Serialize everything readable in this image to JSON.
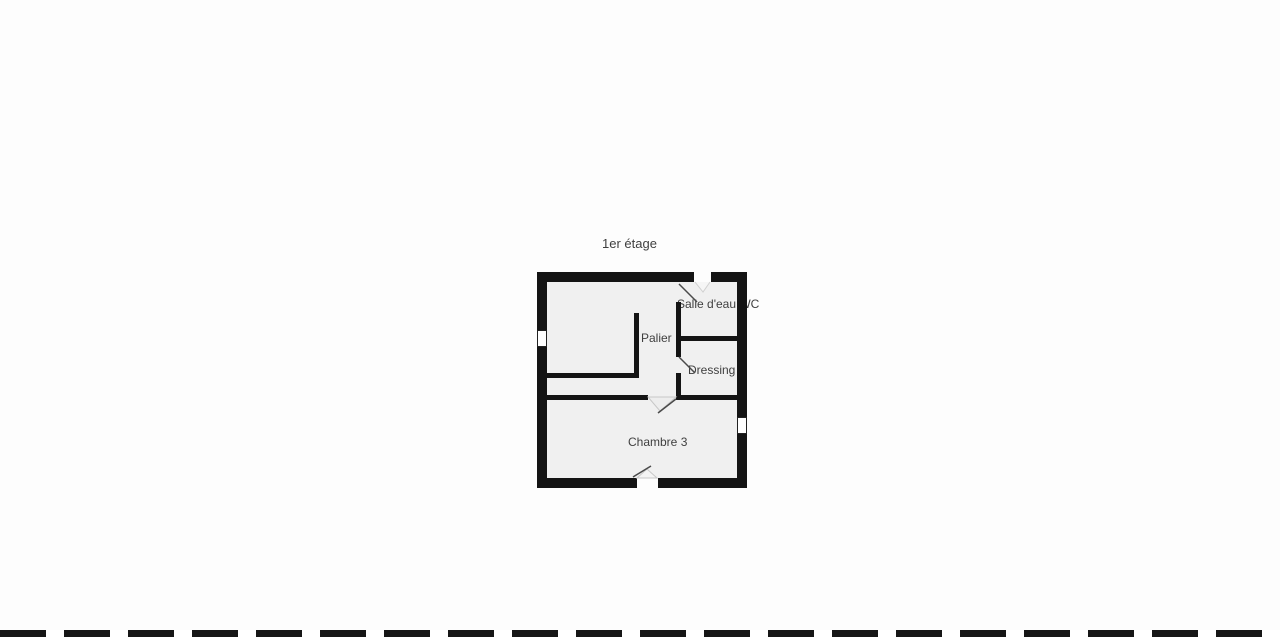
{
  "floorplan": {
    "title": "1er étage",
    "rooms": [
      {
        "name": "Salle d'eau WC"
      },
      {
        "name": "Palier"
      },
      {
        "name": "Dressing"
      },
      {
        "name": "Chambre 3"
      }
    ],
    "symbols": {
      "windows": [
        "left-wall-window",
        "right-wall-window"
      ],
      "doors": [
        "top-wall-door",
        "salle-d-eau-door",
        "dressing-door",
        "chambre-3-door",
        "bottom-wall-door"
      ],
      "stair_wall": "palier-l-shaped-wall"
    },
    "colors": {
      "wall": "#141414",
      "floor": "#f0f0f0",
      "background": "#fdfdfd",
      "label": "#3f3f3f"
    }
  }
}
